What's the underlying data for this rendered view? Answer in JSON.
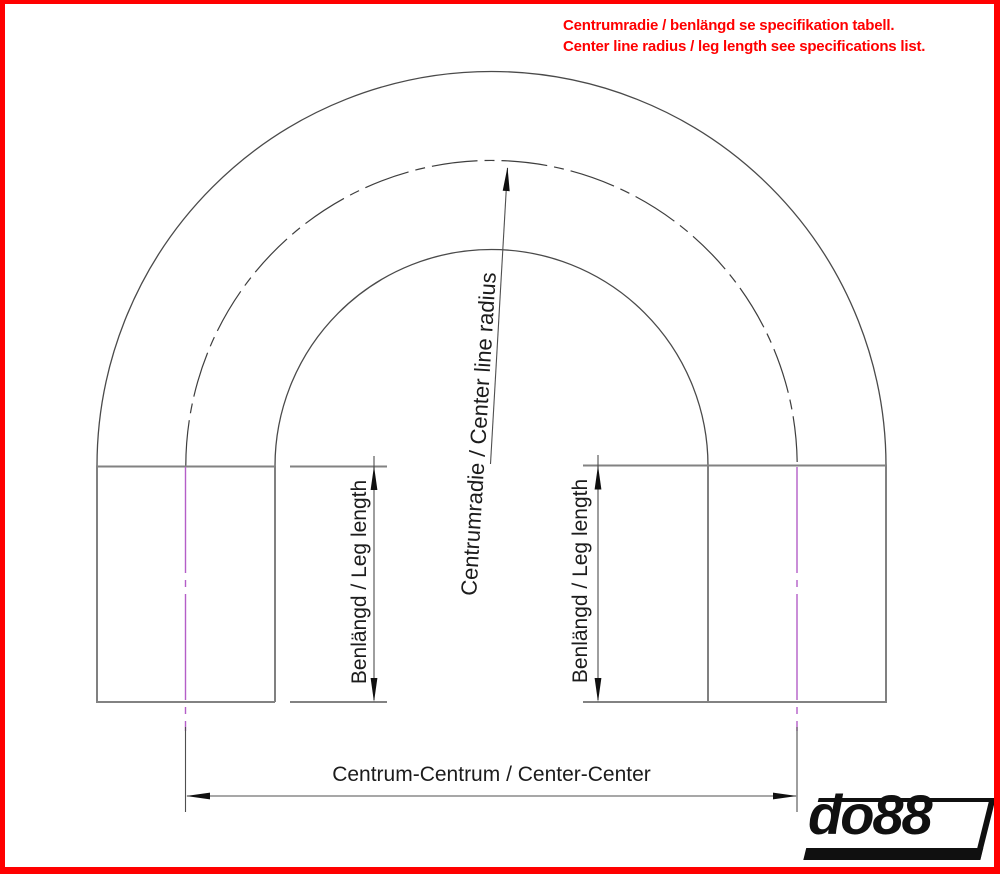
{
  "note": {
    "line1": "Centrumradie / benlängd se specifikation tabell.",
    "line2": "Center line radius / leg length see specifications list.",
    "color": "#ff0000"
  },
  "labels": {
    "center_radius": "Centrumradie / Center line radius",
    "leg_length_left": "Benlängd / Leg length",
    "leg_length_right": "Benlängd / Leg length",
    "center_center": "Centrum-Centrum / Center-Center"
  },
  "logo": {
    "text": "do88"
  },
  "drawing": {
    "subject": "180-degree hose bend, dimension drawing",
    "colors": {
      "page_border": "#ff0000",
      "note_text": "#ff0000",
      "outline": "#4a4a4a",
      "tangent_line": "#828282",
      "dimension_line": "#4f4f4f",
      "centerline_magenta": "#b45ec8",
      "label_text": "#1c1c1c",
      "logo_black": "#101010"
    }
  }
}
